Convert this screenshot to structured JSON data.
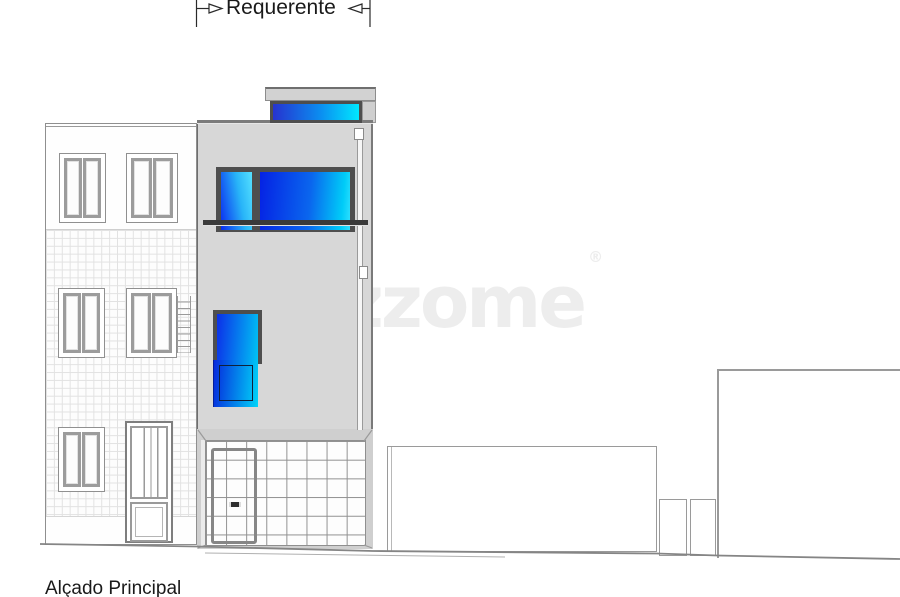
{
  "annotation": {
    "label": "Requerente"
  },
  "footer": {
    "label": "Alçado Principal"
  },
  "watermark": {
    "text": "zzome",
    "registered": "®"
  },
  "colors": {
    "facade_gray": "#d7d7d7",
    "slab_gray": "#d2d2d2",
    "frame_dark": "#4e4e4e",
    "railing_dark": "#3a3a3a",
    "outline_gray": "#8a8a8a",
    "tile_line": "#e2e2e2",
    "glass_deep_blue": "#0a2ae6",
    "glass_cyan": "#00d2f8",
    "glass_light_cyan": "#55e0ff",
    "watermark_gray": "#ededed",
    "ink": "#1a1a1a"
  }
}
